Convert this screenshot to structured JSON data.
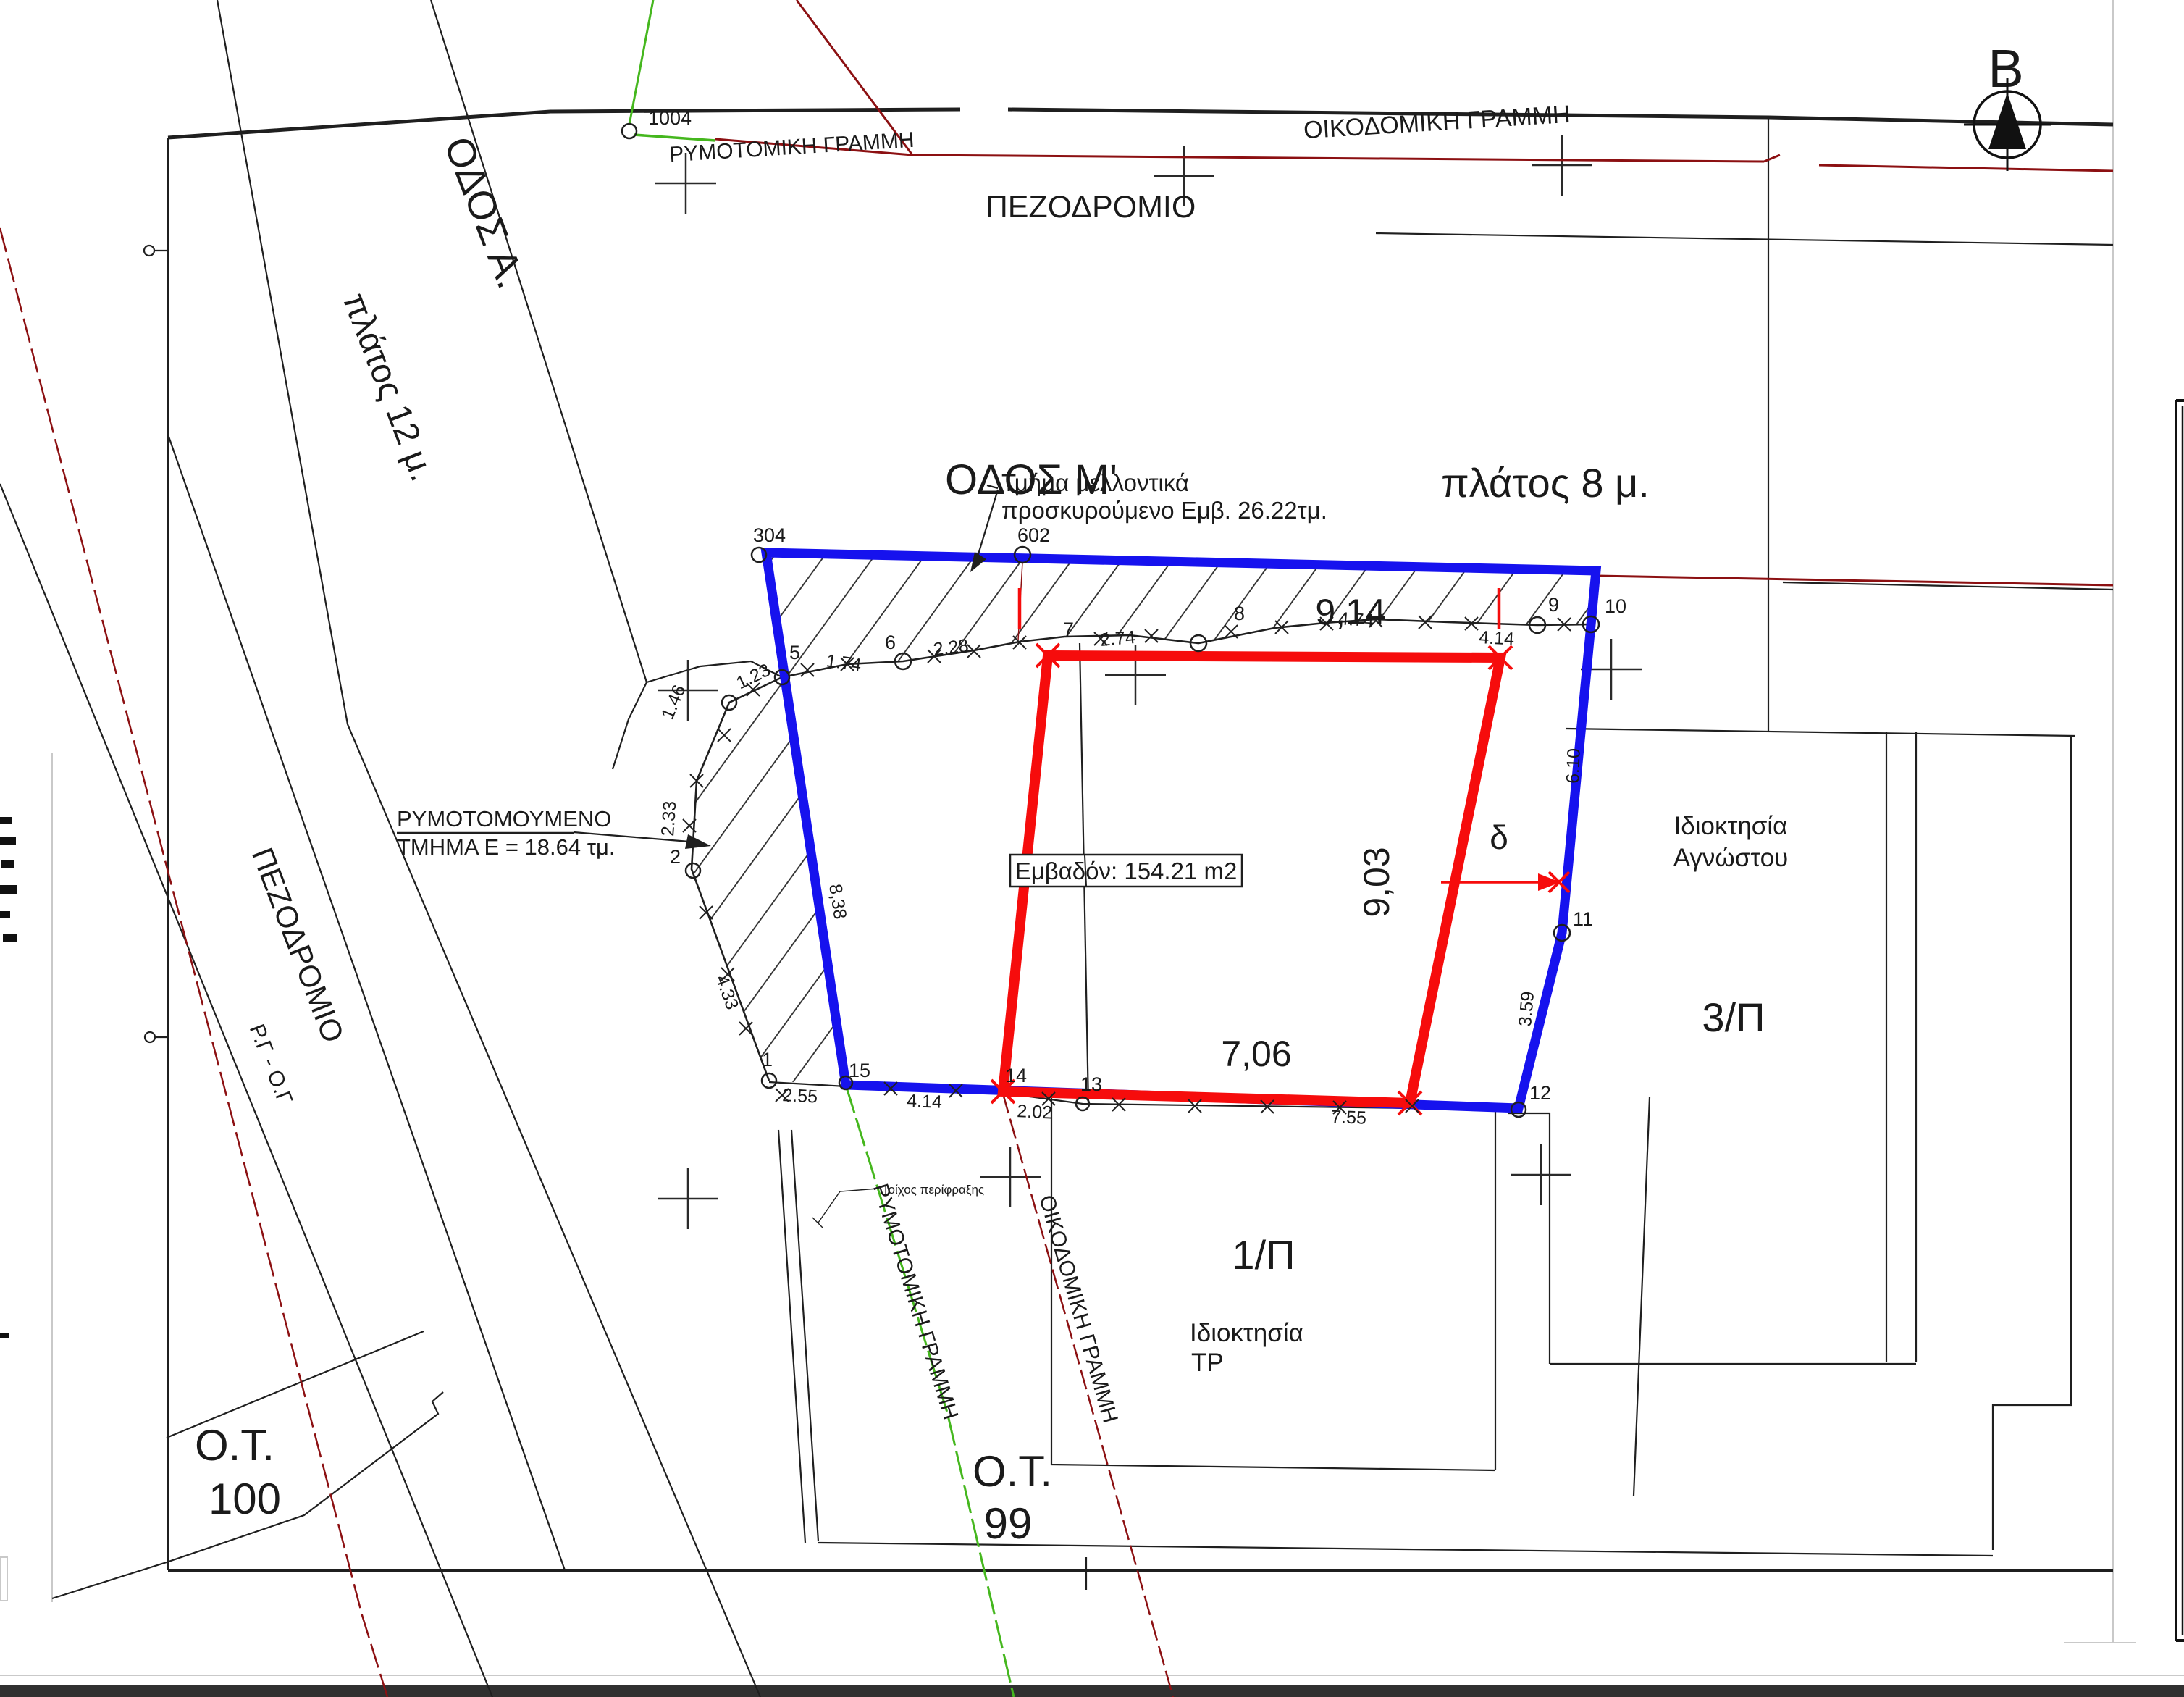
{
  "labels": {
    "north": "Β",
    "odos_m": "ΟΔΟΣ Μ'",
    "platos8": "πλάτος 8 μ.",
    "odos_a": "ΟΔΟΣ Α.",
    "platos12": "πλάτος 12 μ.",
    "pezodromio_top": "ΠΕΖΟΔΡΟΜΙΟ",
    "pezodromio_left": "ΠΕΖΟΔΡΟΜΙΟ",
    "oikodomiki_top": "ΟΙΚΟΔΟΜΙΚΗ ΓΡΑΜΜΗ",
    "rymotomiki_top": "ΡΥΜΟΤΟΜΙΚΗ ΓΡΑΜΜΗ",
    "oikodomiki_bottom": "ΟΙΚΟΔΟΜΙΚΗ ΓΡΑΜΜΗ",
    "rymotomiki_bottom": "ΡΥΜΟΤΟΜΙΚΗ ΓΡΑΜΜΗ",
    "rg_og": "Ρ.Γ - Ο.Γ",
    "ot100_line1": "Ο.Τ.",
    "ot100_line2": "100",
    "ot99_line1": "Ο.Τ.",
    "ot99_line2": "99",
    "parcel_1p": "1/Π",
    "parcel_3p": "3/Π",
    "owner1_line1": "Ιδιοκτησία",
    "owner1_line2": "ΤΡ",
    "owner3_line1": "Ιδιοκτησία",
    "owner3_line2": "Αγνώστου",
    "annex_line1": "Τμήμα μελλοντικά",
    "annex_line2": "προσκυρούμενο Εμβ. 26.22τμ.",
    "rymot_line1": "ΡΥΜΟΤΟΜΟΥΜΕΝΟ",
    "rymot_line2": "ΤΜΗΜΑ Ε = 18.64 τμ.",
    "area_box": "Εμβαδόν: 154.21 m2",
    "wall": "Τοίχος περίφραξης",
    "dim_914": "9,14",
    "dim_903": "9,03",
    "dim_706": "7,06",
    "delta": "δ"
  },
  "points": {
    "p1004": "1004",
    "p304": "304",
    "p602": "602",
    "n1": "1",
    "n2": "2",
    "n5": "5",
    "n6": "6",
    "n7": "7",
    "n8": "8",
    "n9": "9",
    "n10": "10",
    "n11": "11",
    "n12": "12",
    "n13": "13",
    "n14": "14",
    "n15": "15"
  },
  "meas": {
    "m174": "1.74",
    "m228": "2.28",
    "m274": "2.74",
    "m474": "4.74",
    "m414": "4.14",
    "m123": "1.23",
    "m146": "1.46",
    "m233": "2.33",
    "m433": "4.33",
    "m838": "8,38",
    "m255": "2.55",
    "m414b": "4.14",
    "m202": "2.02",
    "m755": "7.55",
    "m610": "6.10",
    "m359": "3.59"
  },
  "colors": {
    "blue": "#1612ee",
    "red": "#f60c0c",
    "dark_red": "#8c1012",
    "green": "#45b71e"
  }
}
